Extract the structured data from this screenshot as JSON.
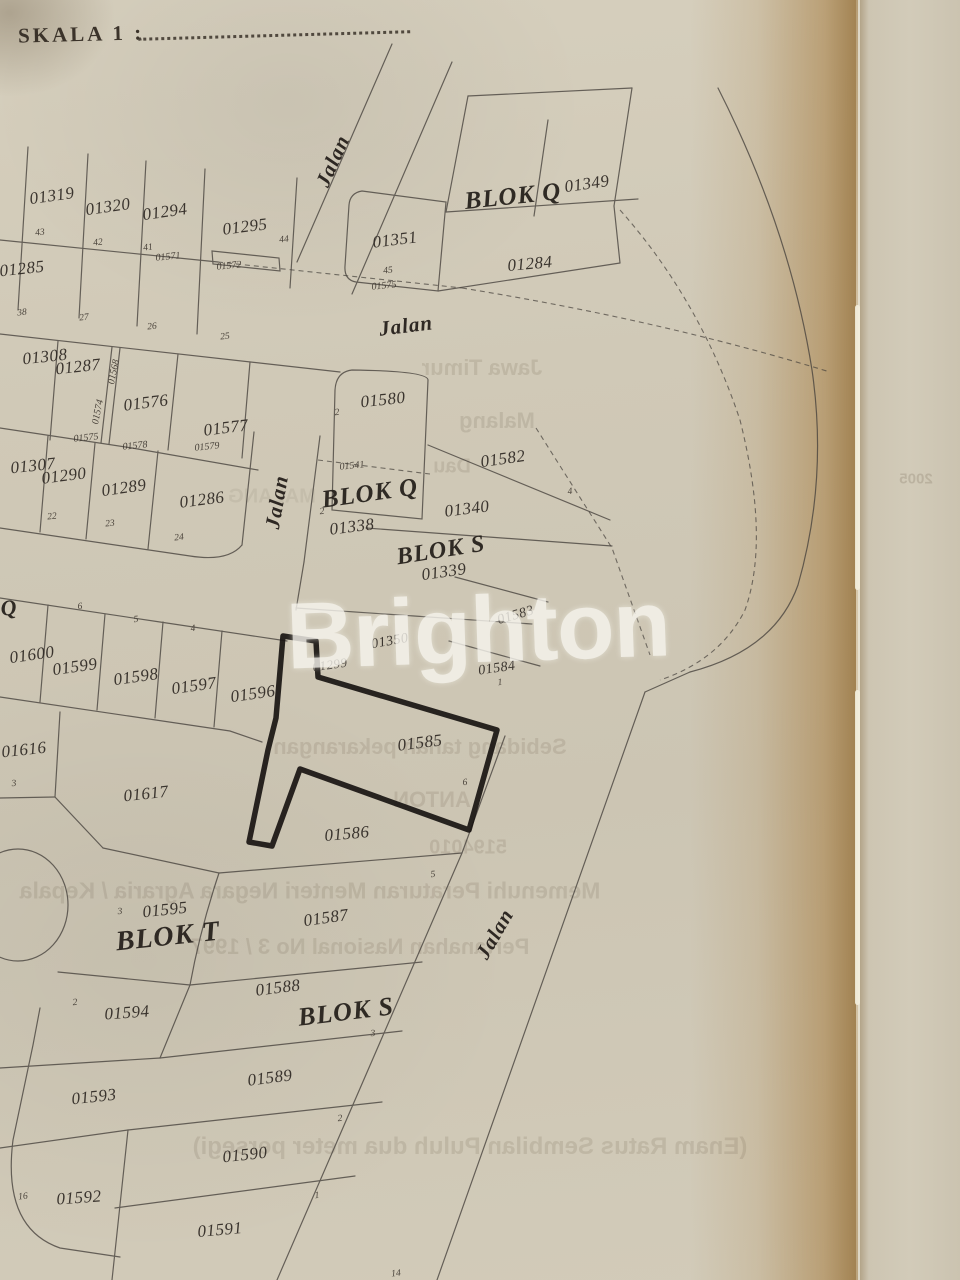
{
  "header": {
    "scale_label": "SKALA 1 :"
  },
  "watermark": {
    "text": "Brighton"
  },
  "map": {
    "highlighted_parcel": "01585",
    "colors": {
      "paper": "#cfc8b6",
      "line": "#46413c",
      "bold_line": "#191512",
      "warm_band": "#b08d58",
      "side_strip": "#cdc5b2",
      "watermark": "#f8f6ef"
    },
    "streets": [
      {
        "name": "Jalan",
        "x": 333,
        "y": 161,
        "r": "-66deg"
      },
      {
        "name": "Jalan",
        "x": 406,
        "y": 326,
        "r": "-7deg"
      },
      {
        "name": "Jalan",
        "x": 277,
        "y": 502,
        "r": "-80deg"
      },
      {
        "name": "Jalan",
        "x": 495,
        "y": 934,
        "r": "-60deg"
      }
    ],
    "blocks": [
      {
        "label": "BLOK Q",
        "x": 513,
        "y": 197,
        "r": "-6deg"
      },
      {
        "label": "Q",
        "x": 9,
        "y": 608,
        "r": "-6deg"
      },
      {
        "label": "BLOK Q",
        "x": 370,
        "y": 494,
        "r": "-8deg"
      },
      {
        "label": "BLOK S",
        "x": 441,
        "y": 551,
        "r": "-9deg"
      },
      {
        "label": "BLOK T",
        "x": 168,
        "y": 937,
        "r": "-6deg"
      },
      {
        "label": "BLOK S",
        "x": 346,
        "y": 1012,
        "r": "-7deg"
      }
    ],
    "parcels": [
      {
        "id": "01319",
        "x": 52,
        "y": 196,
        "r": "-8deg"
      },
      {
        "id": "01320",
        "x": 108,
        "y": 207,
        "r": "-8deg"
      },
      {
        "id": "01294",
        "x": 165,
        "y": 212,
        "r": "-8deg"
      },
      {
        "id": "01295",
        "x": 245,
        "y": 227,
        "r": "-7deg"
      },
      {
        "id": "01285",
        "x": 22,
        "y": 269,
        "r": "-6deg"
      },
      {
        "id": "01349",
        "x": 587,
        "y": 184,
        "r": "-8deg"
      },
      {
        "id": "01351",
        "x": 395,
        "y": 240,
        "r": "-7deg"
      },
      {
        "id": "01284",
        "x": 530,
        "y": 264,
        "r": "-5deg"
      },
      {
        "id": "01308",
        "x": 45,
        "y": 357,
        "r": "-6deg"
      },
      {
        "id": "01287",
        "x": 78,
        "y": 367,
        "r": "-6deg"
      },
      {
        "id": "01576",
        "x": 146,
        "y": 403,
        "r": "-7deg"
      },
      {
        "id": "01577",
        "x": 226,
        "y": 428,
        "r": "-7deg"
      },
      {
        "id": "01580",
        "x": 383,
        "y": 400,
        "r": "-6deg"
      },
      {
        "id": "01582",
        "x": 503,
        "y": 459,
        "r": "-8deg"
      },
      {
        "id": "01307",
        "x": 33,
        "y": 466,
        "r": "-6deg"
      },
      {
        "id": "01290",
        "x": 64,
        "y": 476,
        "r": "-7deg"
      },
      {
        "id": "01289",
        "x": 124,
        "y": 488,
        "r": "-8deg"
      },
      {
        "id": "01286",
        "x": 202,
        "y": 500,
        "r": "-7deg"
      },
      {
        "id": "01338",
        "x": 352,
        "y": 527,
        "r": "-7deg"
      },
      {
        "id": "01340",
        "x": 467,
        "y": 509,
        "r": "-7deg"
      },
      {
        "id": "01339",
        "x": 444,
        "y": 572,
        "r": "-8deg"
      },
      {
        "id": "01600",
        "x": 32,
        "y": 655,
        "r": "-8deg"
      },
      {
        "id": "01599",
        "x": 75,
        "y": 667,
        "r": "-8deg"
      },
      {
        "id": "01598",
        "x": 136,
        "y": 677,
        "r": "-8deg"
      },
      {
        "id": "01597",
        "x": 194,
        "y": 686,
        "r": "-8deg"
      },
      {
        "id": "01596",
        "x": 253,
        "y": 694,
        "r": "-8deg"
      },
      {
        "id": "01350",
        "x": 390,
        "y": 642,
        "r": "-10deg"
      },
      {
        "id": "01299",
        "x": 330,
        "y": 665,
        "r": "-8deg"
      },
      {
        "id": "01583",
        "x": 516,
        "y": 616,
        "r": "-16deg"
      },
      {
        "id": "01584",
        "x": 497,
        "y": 669,
        "r": "-8deg"
      },
      {
        "id": "01616",
        "x": 24,
        "y": 750,
        "r": "-6deg"
      },
      {
        "id": "01617",
        "x": 146,
        "y": 794,
        "r": "-6deg"
      },
      {
        "id": "01585",
        "x": 420,
        "y": 743,
        "r": "-7deg"
      },
      {
        "id": "01586",
        "x": 347,
        "y": 834,
        "r": "-5deg"
      },
      {
        "id": "01595",
        "x": 165,
        "y": 910,
        "r": "-6deg"
      },
      {
        "id": "01587",
        "x": 326,
        "y": 918,
        "r": "-8deg"
      },
      {
        "id": "01594",
        "x": 127,
        "y": 1013,
        "r": "-4deg"
      },
      {
        "id": "01588",
        "x": 278,
        "y": 988,
        "r": "-7deg"
      },
      {
        "id": "01589",
        "x": 270,
        "y": 1078,
        "r": "-7deg"
      },
      {
        "id": "01593",
        "x": 94,
        "y": 1097,
        "r": "-6deg"
      },
      {
        "id": "01590",
        "x": 245,
        "y": 1155,
        "r": "-6deg"
      },
      {
        "id": "01592",
        "x": 79,
        "y": 1198,
        "r": "-4deg"
      },
      {
        "id": "01591",
        "x": 220,
        "y": 1230,
        "r": "-5deg"
      }
    ],
    "small_marks": [
      {
        "t": "43",
        "x": 40,
        "y": 233
      },
      {
        "t": "42",
        "x": 98,
        "y": 243
      },
      {
        "t": "41",
        "x": 148,
        "y": 248
      },
      {
        "t": "44",
        "x": 284,
        "y": 240
      },
      {
        "t": "01571",
        "x": 168,
        "y": 257
      },
      {
        "t": "01572",
        "x": 229,
        "y": 266
      },
      {
        "t": "45",
        "x": 388,
        "y": 271
      },
      {
        "t": "01575",
        "x": 384,
        "y": 286
      },
      {
        "t": "38",
        "x": 22,
        "y": 313
      },
      {
        "t": "27",
        "x": 84,
        "y": 318
      },
      {
        "t": "26",
        "x": 152,
        "y": 327
      },
      {
        "t": "25",
        "x": 225,
        "y": 337
      },
      {
        "t": "01568",
        "x": 114,
        "y": 372,
        "r": "-78deg"
      },
      {
        "t": "01574",
        "x": 98,
        "y": 412,
        "r": "-78deg"
      },
      {
        "t": "01575",
        "x": 86,
        "y": 438
      },
      {
        "t": "01578",
        "x": 135,
        "y": 446
      },
      {
        "t": "01579",
        "x": 207,
        "y": 447
      },
      {
        "t": "22",
        "x": 52,
        "y": 517
      },
      {
        "t": "23",
        "x": 110,
        "y": 524
      },
      {
        "t": "24",
        "x": 179,
        "y": 538
      },
      {
        "t": "01541",
        "x": 352,
        "y": 466
      },
      {
        "t": "2",
        "x": 337,
        "y": 413
      },
      {
        "t": "2",
        "x": 322,
        "y": 512
      },
      {
        "t": "4",
        "x": 570,
        "y": 492
      },
      {
        "t": "6",
        "x": 80,
        "y": 607
      },
      {
        "t": "5",
        "x": 136,
        "y": 620
      },
      {
        "t": "4",
        "x": 193,
        "y": 629
      },
      {
        "t": "1",
        "x": 500,
        "y": 683
      },
      {
        "t": "6",
        "x": 465,
        "y": 783
      },
      {
        "t": "3",
        "x": 14,
        "y": 784
      },
      {
        "t": "3",
        "x": 120,
        "y": 912
      },
      {
        "t": "5",
        "x": 433,
        "y": 875
      },
      {
        "t": "2",
        "x": 75,
        "y": 1003
      },
      {
        "t": "3",
        "x": 373,
        "y": 1034
      },
      {
        "t": "2",
        "x": 340,
        "y": 1119
      },
      {
        "t": "1",
        "x": 317,
        "y": 1196
      },
      {
        "t": "16",
        "x": 23,
        "y": 1197
      },
      {
        "t": "14",
        "x": 396,
        "y": 1274
      }
    ],
    "showthrough": [
      {
        "text": "Jawa Timur",
        "x": 482,
        "y": 368,
        "s": 22
      },
      {
        "text": "Malang",
        "x": 497,
        "y": 421,
        "s": 22
      },
      {
        "text": "Dau",
        "x": 452,
        "y": 467,
        "s": 20
      },
      {
        "text": "MALANG",
        "x": 272,
        "y": 497,
        "s": 20
      },
      {
        "text": "Sebidang tanah pekarangan",
        "x": 420,
        "y": 747,
        "s": 22
      },
      {
        "text": "ANTON",
        "x": 432,
        "y": 800,
        "s": 22
      },
      {
        "text": "5194010",
        "x": 468,
        "y": 848,
        "s": 20
      },
      {
        "text": "Memenuhi Peraturan Menteri Negara Agraria / Kepala",
        "x": 310,
        "y": 891,
        "s": 23
      },
      {
        "text": "Pertanahan Nasional No 3 / 1997",
        "x": 360,
        "y": 947,
        "s": 22
      },
      {
        "text": "(Enam Ratus Sembilan Puluh dua meter persegi)",
        "x": 470,
        "y": 1147,
        "s": 24
      },
      {
        "text": "2005",
        "x": 916,
        "y": 479,
        "s": 15
      }
    ]
  }
}
